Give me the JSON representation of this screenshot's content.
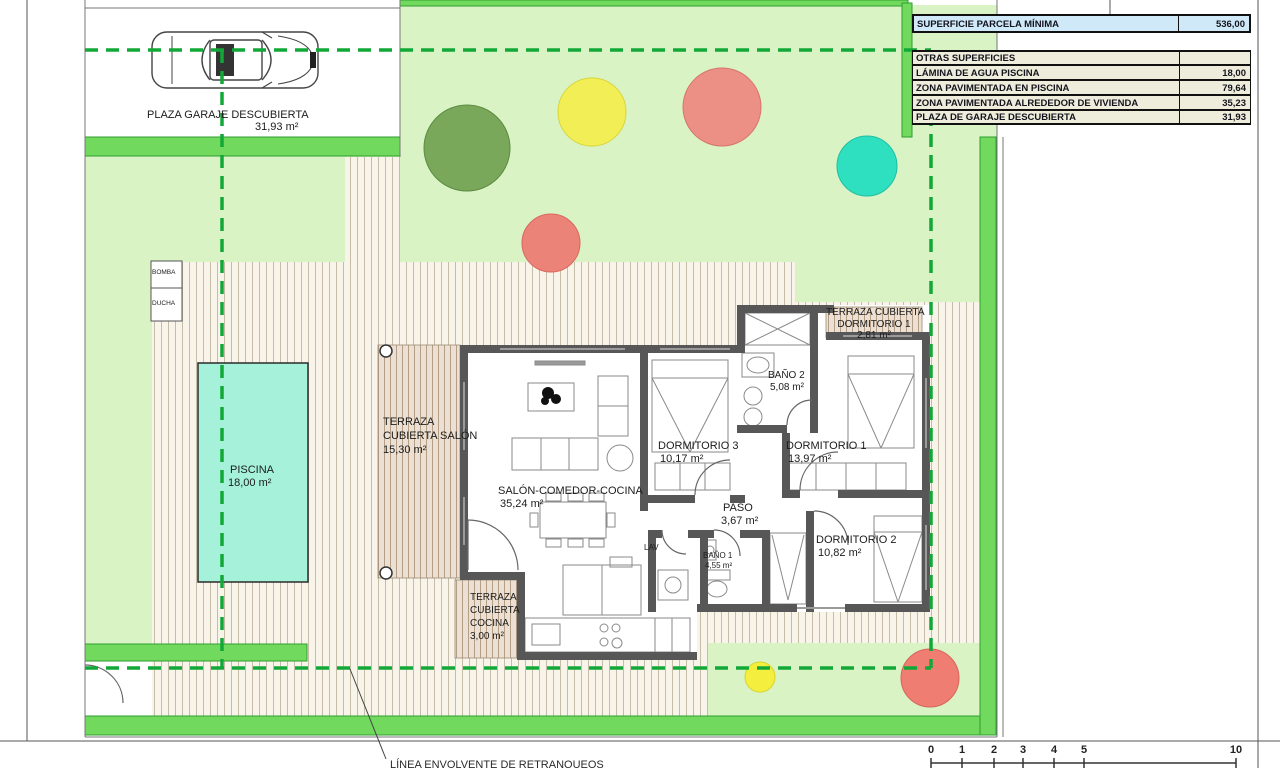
{
  "summary_table": {
    "parcela": {
      "label": "SUPERFICIE PARCELA MÍNIMA",
      "value": "536,00"
    },
    "rows": [
      {
        "label": "OTRAS SUPERFICIES",
        "value": ""
      },
      {
        "label": "LÁMINA DE AGUA PISCINA",
        "value": "18,00"
      },
      {
        "label": "ZONA PAVIMENTADA EN PISCINA",
        "value": "79,64"
      },
      {
        "label": "ZONA PAVIMENTADA ALREDEDOR DE VIVIENDA",
        "value": "35,23"
      },
      {
        "label": "PLAZA DE GARAJE DESCUBIERTA",
        "value": "31,93"
      }
    ]
  },
  "garage": {
    "label": "PLAZA GARAJE DESCUBIERTA",
    "area": "31,93 m²"
  },
  "equipment": {
    "bomba": "BOMBA",
    "ducha": "DUCHA"
  },
  "pool": {
    "name": "PISCINA",
    "area": "18,00 m²"
  },
  "rooms": {
    "terraza_salon": {
      "l1": "TERRAZA",
      "l2": "CUBIERTA SALÓN",
      "area": "15,30 m²"
    },
    "salon": {
      "name": "SALÓN-COMEDOR-COCINA",
      "area": "35,24 m²"
    },
    "terraza_cocina": {
      "l1": "TERRAZA",
      "l2": "CUBIERTA",
      "l3": "COCINA",
      "area": "3,00 m²"
    },
    "dormitorio3": {
      "name": "DORMITORIO 3",
      "area": "10,17 m²"
    },
    "dormitorio1": {
      "name": "DORMITORIO 1",
      "area": "13,97 m²"
    },
    "dormitorio2": {
      "name": "DORMITORIO 2",
      "area": "10,82 m²"
    },
    "banyo2": {
      "name": "BAÑO 2",
      "area": "5,08 m²"
    },
    "banyo1": {
      "name": "BAÑO 1",
      "area": "4,55 m²"
    },
    "paso": {
      "name": "PASO",
      "area": "3,67 m²"
    },
    "lav": {
      "name": "LAV"
    },
    "terraza_dorm1": {
      "l1": "TERRAZA CUBIERTA",
      "l2": "DORMITORIO 1",
      "area": "2,81 m²"
    }
  },
  "annotation": {
    "retranqueo_note": "LÍNEA ENVOLVENTE DE RETRANQUEOS"
  },
  "scale": {
    "ticks": [
      "0",
      "1",
      "2",
      "3",
      "4",
      "5",
      "10"
    ]
  },
  "colors": {
    "lawn": "#d9f3c5",
    "plot_border_green": "#70d95e",
    "setback_dashed_green": "#12a837",
    "pool_water": "#a5f1da",
    "paving_bg": "#f8f4e9",
    "terrace_hatch": "#ebe0d3",
    "wall_gray": "#575757",
    "table_header_blue": "#cfe9f8",
    "table_row_beige": "#eeeddb",
    "tree_green": "#7aa85a",
    "tree_yellow": "#f2ee55",
    "tree_salmon": "#ec8f85",
    "tree_teal": "#2fe0c0"
  }
}
